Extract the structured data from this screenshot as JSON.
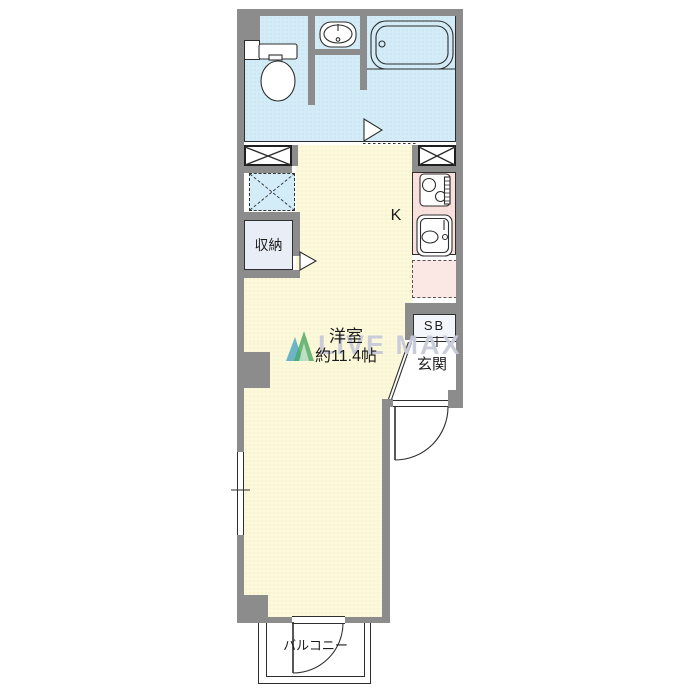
{
  "colors": {
    "wall": "#8c8c8c",
    "line": "#2e2e2e",
    "text": "#1c1c1c",
    "bath-floor": "#d3ecf8",
    "room-floor": "#fcf8da",
    "kitchen-floor": "#f9e2de",
    "fridge-fill": "#fbe7e4",
    "closet-floor": "#e9eef6",
    "washer-fill": "#d3ecf8",
    "sb-fill": "#f3f7fb",
    "white": "#ffffff",
    "watermark": "#c7cad9",
    "logo-green": "#49a860",
    "logo-teal": "#3b9fc0"
  },
  "labels": {
    "room_name": "洋室",
    "room_size": "約11.4帖",
    "kitchen": "K",
    "closet": "収納",
    "shoe_box": "SB",
    "entrance": "玄関",
    "balcony": "バルコニー",
    "watermark": "LIVE MAX"
  }
}
